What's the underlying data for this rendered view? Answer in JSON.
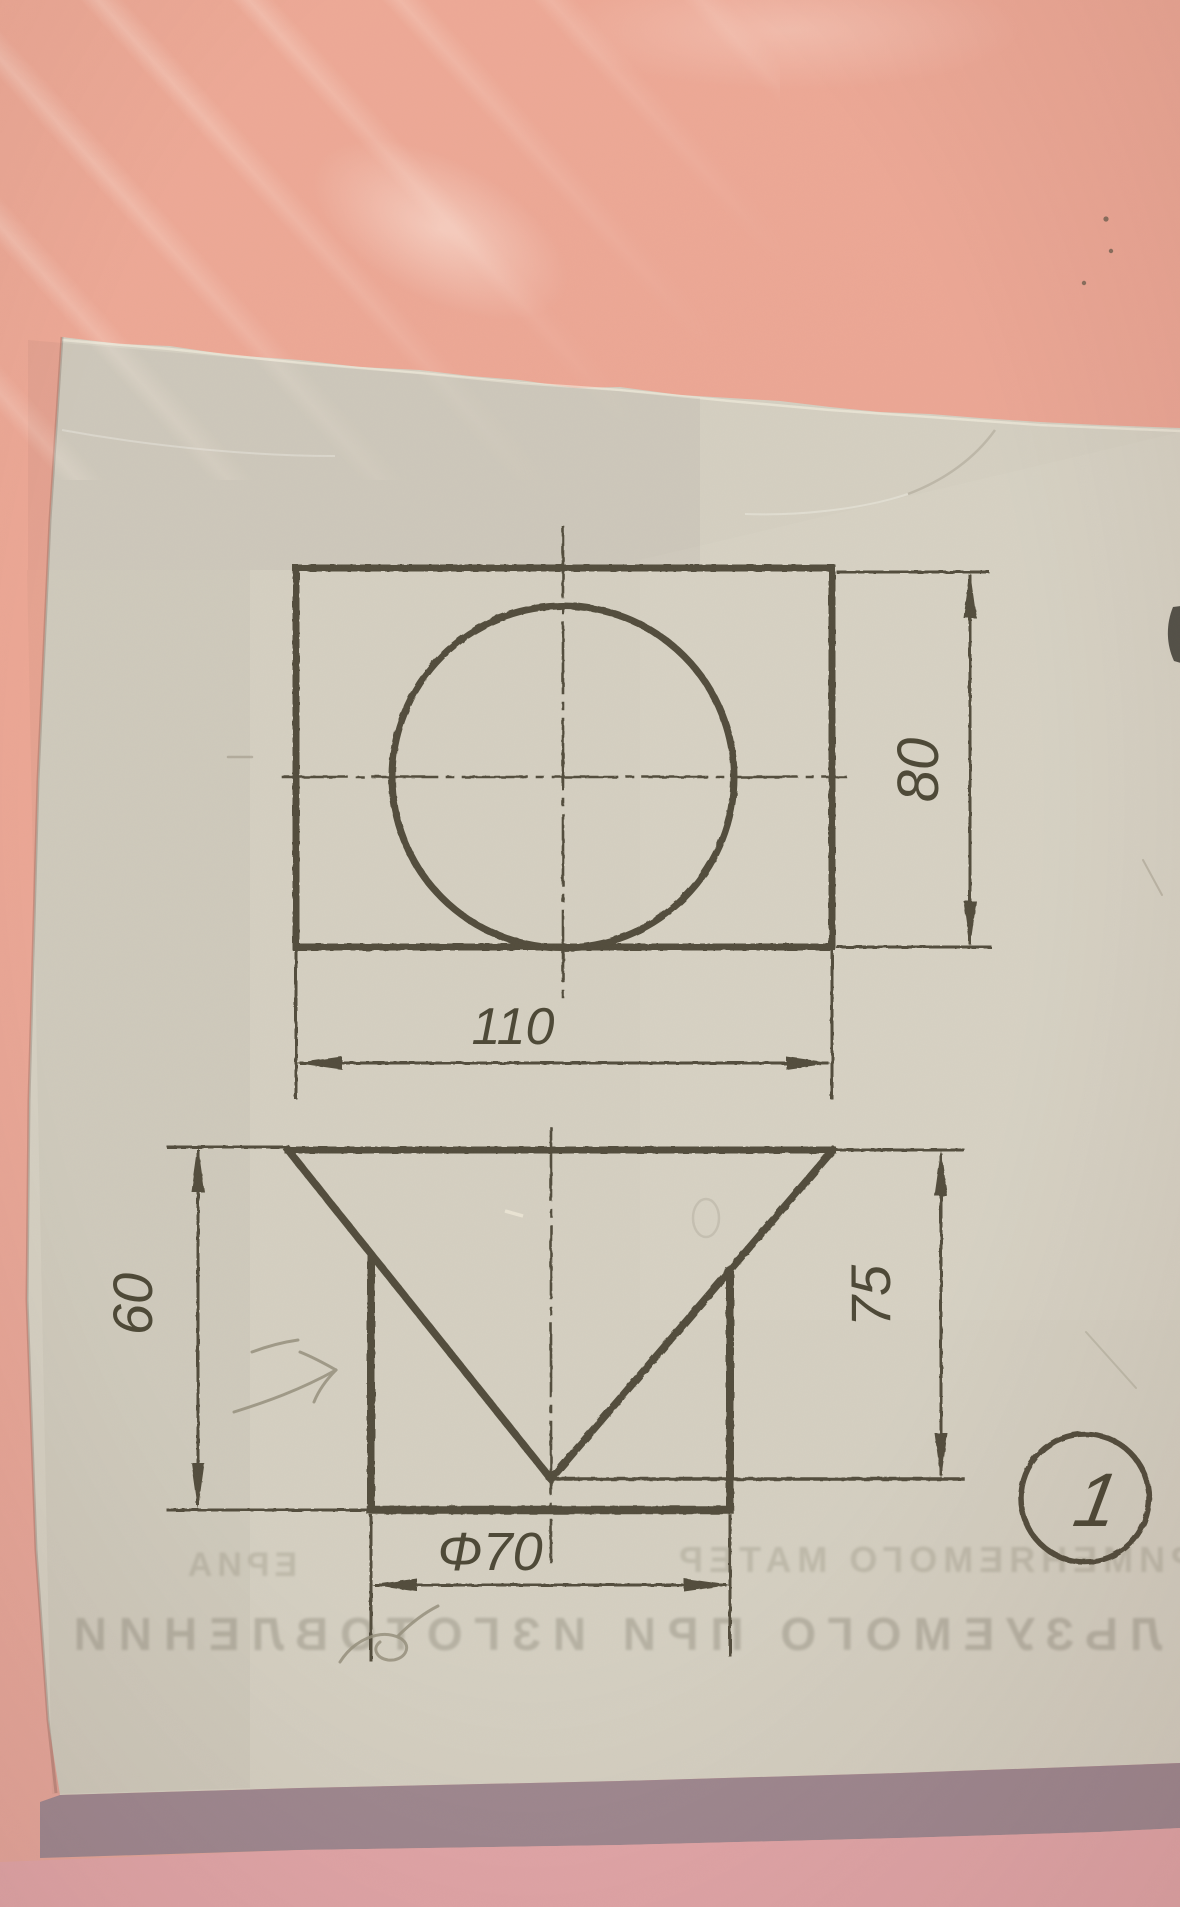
{
  "scene": {
    "kind": "photo of a textbook engineering drawing on a pink desk",
    "surface_colors": {
      "top": "#ECA795",
      "bottom": "#E2A6A8",
      "shadow_band": "#9F8890"
    },
    "paper_color": "#D5D0C2",
    "ink_color": "#534E3C",
    "pencil_color": "#97907E"
  },
  "drawing": {
    "top_view": {
      "shape": "rectangle with inscribed circle and dash-dot centerlines",
      "width_dim": "110",
      "depth_dim": "80"
    },
    "front_view": {
      "shape": "inverted triangle (cone) over rectangle (cylinder)",
      "left_height_dim": "60",
      "right_height_dim": "75",
      "diameter_dim": "Φ70"
    },
    "figure_number": "1"
  },
  "bleed_through_text": {
    "row_small_left": "ЕРИА",
    "row_small_right": "ПРИМЕНЯЕМОГО МАТЕР",
    "row_large": "ЛЬЗУЕМОГО ПРИ ИЗГОТОВЛЕНИИ"
  }
}
